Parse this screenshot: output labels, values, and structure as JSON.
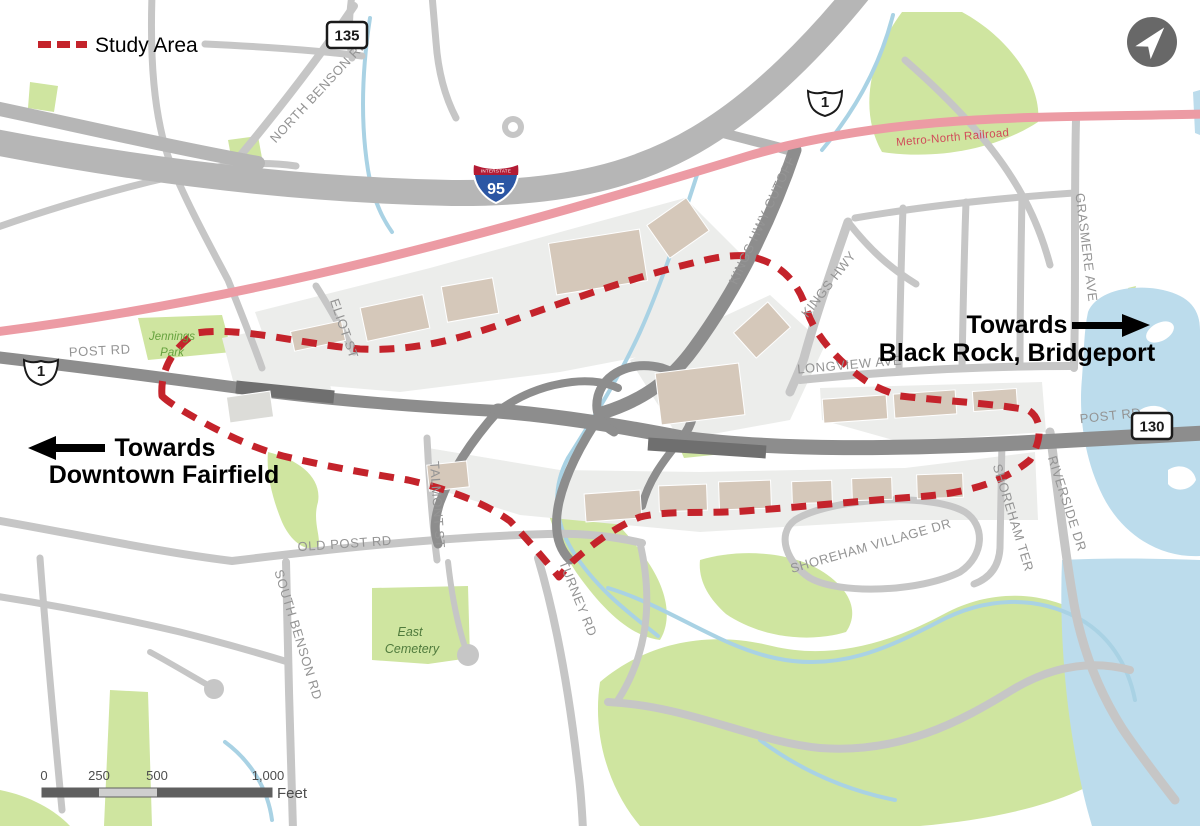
{
  "legend": {
    "study_area_label": "Study Area"
  },
  "route_shields": {
    "ct_135": "135",
    "us_1_north": "1",
    "us_1_west": "1",
    "interstate_header": "INTERSTATE",
    "i_95": "95",
    "ct_130": "130"
  },
  "railroad": {
    "label": "Metro-North Railroad"
  },
  "road_labels": {
    "north_benson_rd": "NORTH BENSON RD",
    "kings_hwy_cutoff": "KINGS HWY CUTOFF",
    "kings_hwy": "KINGS HWY",
    "grasmere_ave": "GRASMERE AVE",
    "longview_ave": "LONGVIEW AVE",
    "post_rd_west": "POST RD",
    "post_rd_east": "POST RD",
    "old_post_rd": "OLD POST RD",
    "south_benson_rd": "SOUTH BENSON RD",
    "turney_rd": "TURNEY RD",
    "talmont_st": "TALMONT ST",
    "eliot_st": "ELIOT ST",
    "shoreham_ter": "SHOREHAM TER",
    "shoreham_village_dr": "SHOREHAM VILLAGE DR",
    "riverside_dr": "RIVERSIDE DR"
  },
  "place_labels": {
    "jennings_park_l1": "Jennings",
    "jennings_park_l2": "Park",
    "east_cemetery_l1": "East",
    "east_cemetery_l2": "Cemetery"
  },
  "direction_callouts": {
    "west": {
      "line1": "Towards",
      "line2": "Downtown Fairfield"
    },
    "east": {
      "line1": "Towards",
      "line2": "Black Rock, Bridgeport"
    }
  },
  "scale_bar": {
    "tick_0": "0",
    "tick_250": "250",
    "tick_500": "500",
    "tick_1000": "1,000",
    "unit": "Feet"
  },
  "colors": {
    "study_area_red": "#c4232b",
    "railroad_pink": "#ec9ba4",
    "railroad_text": "#d14b59",
    "water_blue": "#bcdcec",
    "park_green": "#cfe5a0",
    "road_gray": "#c6c6c6",
    "arterial_gray": "#8d8d8d",
    "highway_gray": "#b6b6b6",
    "building_tan": "#d5c8ba"
  }
}
